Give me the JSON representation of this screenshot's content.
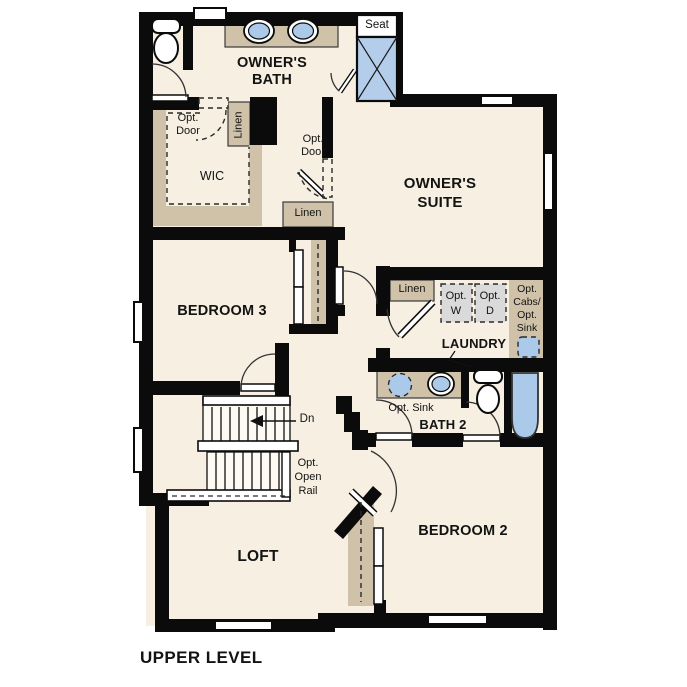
{
  "plan_title": "UPPER LEVEL",
  "rooms": {
    "owners_bath": {
      "line1": "OWNER'S",
      "line2": "BATH"
    },
    "owners_suite": {
      "line1": "OWNER'S",
      "line2": "SUITE"
    },
    "wic": "WIC",
    "bedroom3": "BEDROOM 3",
    "laundry": "LAUNDRY",
    "bath2": "BATH 2",
    "bedroom2": "BEDROOM 2",
    "loft": "LOFT"
  },
  "annotations": {
    "seat": "Seat",
    "wic_opt_door": {
      "line1": "Opt.",
      "line2": "Door"
    },
    "suite_opt_door": {
      "line1": "Opt.",
      "line2": "Door"
    },
    "wic_linen": "Linen",
    "hall_linen": "Linen",
    "laundry_linen": "Linen",
    "opt_washer": {
      "line1": "Opt.",
      "line2": "W"
    },
    "opt_dryer": {
      "line1": "Opt.",
      "line2": "D"
    },
    "opt_cabs_sink": {
      "line1": "Opt.",
      "line2": "Cabs/",
      "line3": "Opt.",
      "line4": "Sink"
    },
    "bath2_opt_sink": "Opt. Sink",
    "stairs_down": "Dn",
    "opt_open_rail": {
      "line1": "Opt.",
      "line2": "Open",
      "line3": "Rail"
    }
  },
  "colors": {
    "wall": "#0b0b0b",
    "floor": "#f6efe2",
    "cabinet_tan": "#cfc2a8",
    "fixture_blue": "#abc9e9",
    "appliance_gray": "#dadada",
    "line": "#2a2a2a"
  }
}
